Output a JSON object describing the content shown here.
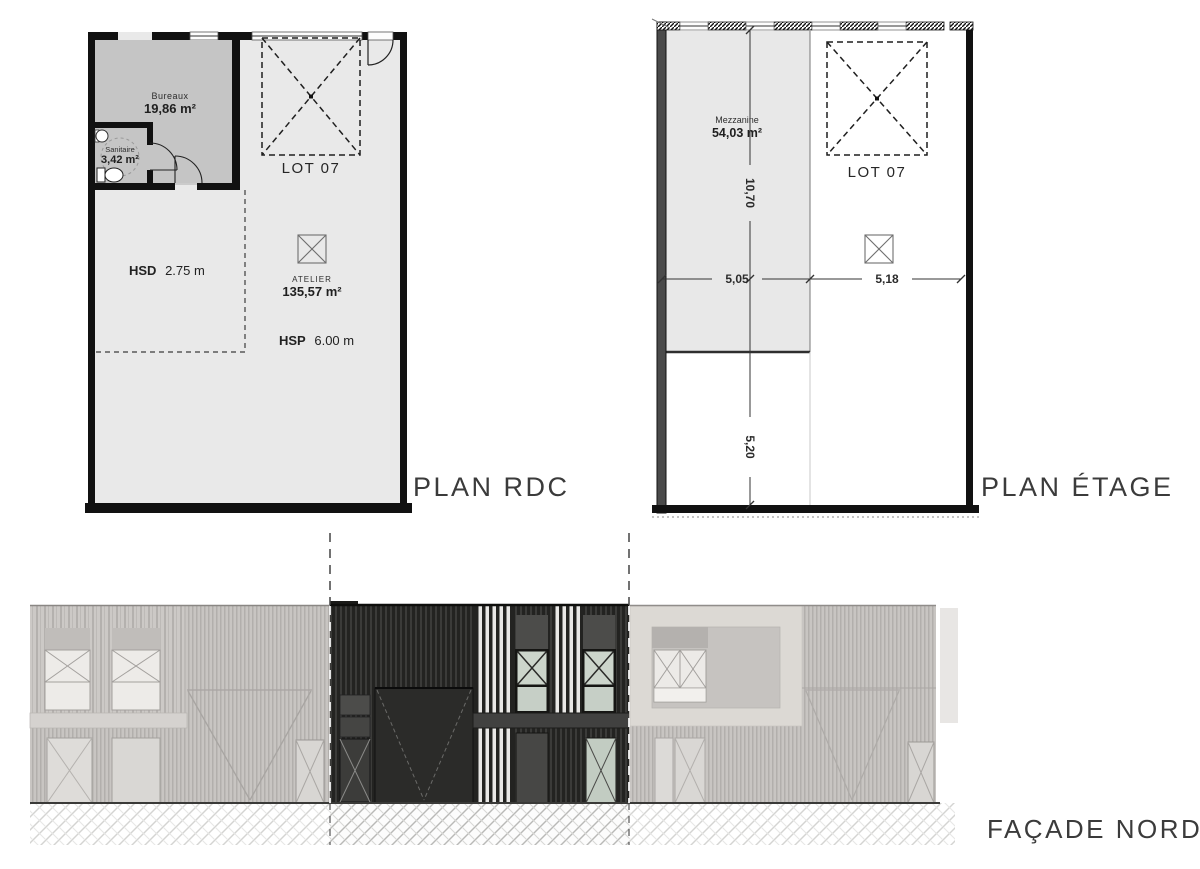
{
  "page": {
    "width": 1200,
    "height": 869,
    "background": "#ffffff"
  },
  "colors": {
    "wall": "#111111",
    "plan_floor": "#e9e9e9",
    "room_gray": "#c5c5c5",
    "mezzanine_gray": "#e8e8e8",
    "facade_dark": "#232321",
    "facade_faded": "#c8c5c2",
    "glass_green": "#ccd5cb",
    "beige_panel": "#dcd9d4",
    "canopy_dark": "#414140"
  },
  "plan_rdc": {
    "title": "PLAN RDC",
    "bureaux_label": "Bureaux",
    "bureaux_area": "19,86 m²",
    "sanitaire_label": "Sanitaire",
    "sanitaire_area": "3,42 m²",
    "lot_label": "LOT 07",
    "hsd_label": "HSD",
    "hsd_value": "2.75 m",
    "atelier_label": "ATELIER",
    "atelier_area": "135,57 m²",
    "hsp_label": "HSP",
    "hsp_value": "6.00 m"
  },
  "plan_etage": {
    "title": "PLAN ÉTAGE",
    "mezzanine_label": "Mezzanine",
    "mezzanine_area": "54,03 m²",
    "lot_label": "LOT 07",
    "dim_vertical_top": "10,70",
    "dim_vertical_bottom": "5,20",
    "dim_horizontal_left": "5,05",
    "dim_horizontal_right": "5,18"
  },
  "facade": {
    "title": "FAÇADE NORD"
  }
}
